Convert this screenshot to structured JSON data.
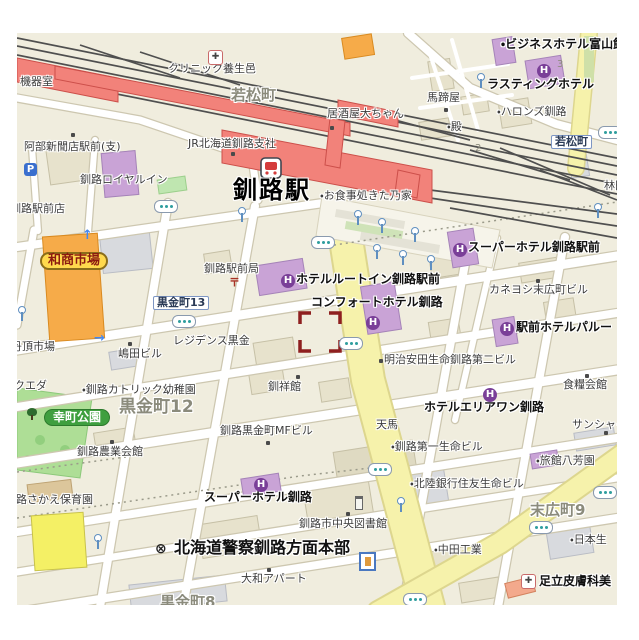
{
  "map": {
    "region_name": "釧路駅周辺 (Kushiro Station area)",
    "palette": {
      "station_red": "#f2827a",
      "hotel_purple": "#c9a3d6",
      "hotel_icon_purple": "#7a3f98",
      "market_orange": "#f6ab49",
      "park_green": "#aede96",
      "road_yellow": "#f6f2ab",
      "rail_gray": "#4f4f4f",
      "target_marker_red": "#8e1f1f",
      "block_beige": "#f0edde"
    },
    "labels": [
      {
        "text": "機器室",
        "x": 20,
        "y": 76,
        "cls": "poi",
        "name": "label-kikishitsu"
      },
      {
        "text": "クリニック養生邑",
        "x": 168,
        "y": 63,
        "cls": "poi",
        "name": "label-clinic-yojomura"
      },
      {
        "text": "若松町",
        "x": 231,
        "y": 88,
        "cls": "town",
        "name": "label-wakamatsucho"
      },
      {
        "text": "居酒屋大ちゃん",
        "x": 327,
        "y": 108,
        "cls": "poi",
        "name": "label-izakaya-daichan"
      },
      {
        "text": "馬蹄屋",
        "x": 427,
        "y": 92,
        "cls": "poi",
        "name": "label-bateiya"
      },
      {
        "text": "・殿",
        "x": 447,
        "y": 121,
        "cls": "poi",
        "name": "label-tono"
      },
      {
        "text": "・ビジネスホテル富山館",
        "x": 501,
        "y": 38,
        "cls": "hotel",
        "name": "label-business-hotel-toyamakan"
      },
      {
        "text": "ラスティングホテル",
        "x": 487,
        "y": 78,
        "cls": "hotel",
        "name": "label-lasting-hotel"
      },
      {
        "text": "・ハロンズ釧路",
        "x": 497,
        "y": 106,
        "cls": "poi",
        "name": "label-hallons-kushiro"
      },
      {
        "text": "若松町",
        "x": 551,
        "y": 135,
        "cls": "busbox",
        "name": "busstop-wakamatsucho"
      },
      {
        "text": "林田",
        "x": 604,
        "y": 180,
        "cls": "poi",
        "name": "label-hayashida"
      },
      {
        "text": "3",
        "x": 557,
        "y": 60,
        "cls": "num",
        "name": "label-block-3"
      },
      {
        "text": "2",
        "x": 475,
        "y": 144,
        "cls": "num",
        "name": "label-block-2"
      },
      {
        "text": "JR北海道釧路支社",
        "x": 188,
        "y": 138,
        "cls": "poi",
        "name": "label-jr-hokkaido-kushiro-branch"
      },
      {
        "text": "釧路駅",
        "x": 233,
        "y": 178,
        "cls": "station-name",
        "name": "label-kushiro-station"
      },
      {
        "text": "・お食事処きた乃家",
        "x": 320,
        "y": 190,
        "cls": "poi",
        "name": "label-oshokujidokoro-kitanoya"
      },
      {
        "text": "阿部新聞店駅前(支)",
        "x": 24,
        "y": 141,
        "cls": "poi",
        "name": "label-abe-shimbunten"
      },
      {
        "text": "釧路ロイヤルイン",
        "x": 80,
        "y": 174,
        "cls": "poi",
        "name": "label-kushiro-royal-inn"
      },
      {
        "text": "釧路駅前店",
        "x": 10,
        "y": 203,
        "cls": "poi",
        "name": "label-kushiro-ekimaeten"
      },
      {
        "text": "スーパーホテル釧路駅前",
        "x": 468,
        "y": 241,
        "cls": "hotel",
        "name": "label-super-hotel-kushiro-ekimae"
      },
      {
        "text": "和商市場",
        "x": 40,
        "y": 252,
        "cls": "pill-yellow",
        "name": "label-washo-ichiba"
      },
      {
        "text": "黒金町13",
        "x": 153,
        "y": 296,
        "cls": "busbox",
        "name": "busstop-kuroganecho-13"
      },
      {
        "text": "カネヨシ末広町ビル",
        "x": 489,
        "y": 284,
        "cls": "poi",
        "name": "label-kaneyoshi-suehirocho-bldg"
      },
      {
        "text": "ホテルルートイン釧路駅前",
        "x": 296,
        "y": 273,
        "cls": "hotel",
        "name": "label-hotel-route-inn-kushiro-ekimae"
      },
      {
        "text": "釧路駅前局",
        "x": 204,
        "y": 263,
        "cls": "poi",
        "name": "label-kushiro-ekimae-post-office"
      },
      {
        "text": "コンフォートホテル釧路",
        "x": 311,
        "y": 296,
        "cls": "hotel",
        "name": "label-comfort-hotel-kushiro"
      },
      {
        "text": "駅前ホテルパルー",
        "x": 516,
        "y": 321,
        "cls": "hotel",
        "name": "label-ekimae-hotel-paroo"
      },
      {
        "text": "明治安田生命釧路第二ビル",
        "x": 384,
        "y": 354,
        "cls": "poi",
        "name": "label-meiji-yasuda-seimei-2nd-bldg"
      },
      {
        "text": "レジデンス黒金",
        "x": 173,
        "y": 335,
        "cls": "poi",
        "name": "label-residence-kurogane"
      },
      {
        "text": "嶋田ビル",
        "x": 118,
        "y": 348,
        "cls": "poi",
        "name": "label-shimada-bldg"
      },
      {
        "text": "丹頂市場",
        "x": 11,
        "y": 341,
        "cls": "poi",
        "name": "label-tancho-ichiba"
      },
      {
        "text": "・釧路カトリック幼稚園",
        "x": 82,
        "y": 384,
        "cls": "poi",
        "name": "label-kushiro-catholic-kindergarten"
      },
      {
        "text": "黒金町12",
        "x": 119,
        "y": 399,
        "cls": "town-lg",
        "name": "label-kuroganecho-12"
      },
      {
        "text": "幸町公園",
        "x": 44,
        "y": 409,
        "cls": "pill-green",
        "name": "label-saiwaicho-park"
      },
      {
        "text": "クエダ",
        "x": 14,
        "y": 380,
        "cls": "poi",
        "name": "label-kueda"
      },
      {
        "text": "釧祥館",
        "x": 268,
        "y": 381,
        "cls": "poi",
        "name": "label-senshokan"
      },
      {
        "text": "食糧会館",
        "x": 563,
        "y": 379,
        "cls": "poi",
        "name": "label-shokuryo-kaikan"
      },
      {
        "text": "ホテルエリアワン釧路",
        "x": 424,
        "y": 401,
        "cls": "hotel",
        "name": "label-hotel-area-one-kushiro"
      },
      {
        "text": "天馬",
        "x": 376,
        "y": 419,
        "cls": "poi",
        "name": "label-tenma"
      },
      {
        "text": "釧路農業会館",
        "x": 77,
        "y": 446,
        "cls": "poi",
        "name": "label-kushiro-nogyo-kaikan"
      },
      {
        "text": "・釧路第一生命ビル",
        "x": 391,
        "y": 441,
        "cls": "poi",
        "name": "label-kushiro-daiichi-seimei-bldg"
      },
      {
        "text": "サンシャイ",
        "x": 572,
        "y": 419,
        "cls": "poi",
        "name": "label-sunshine"
      },
      {
        "text": "・旅館八芳園",
        "x": 536,
        "y": 455,
        "cls": "poi",
        "name": "label-ryokan-happoen"
      },
      {
        "text": "・北陸銀行住友生命ビル",
        "x": 410,
        "y": 478,
        "cls": "poi",
        "name": "label-hokuriku-bank-sumitomo-seimei-bldg"
      },
      {
        "text": "路さかえ保育園",
        "x": 16,
        "y": 494,
        "cls": "poi",
        "name": "label-sakae-hoikuen"
      },
      {
        "text": "釧路黒金町MFビル",
        "x": 220,
        "y": 425,
        "cls": "poi",
        "name": "label-kushiro-kuroganecho-mf-bldg"
      },
      {
        "text": "スーパーホテル釧路",
        "x": 204,
        "y": 491,
        "cls": "hotel",
        "name": "label-super-hotel-kushiro"
      },
      {
        "text": "釧路市中央図書館",
        "x": 299,
        "y": 518,
        "cls": "poi",
        "name": "label-kushiro-central-library"
      },
      {
        "text": "末広町9",
        "x": 530,
        "y": 503,
        "cls": "town",
        "name": "label-suehirocho-9"
      },
      {
        "text": "北海道警察釧路方面本部",
        "x": 174,
        "y": 540,
        "cls": "police",
        "name": "label-hokkaido-police-kushiro-hq"
      },
      {
        "text": "・中田工業",
        "x": 434,
        "y": 544,
        "cls": "poi",
        "name": "label-nakata-kogyo"
      },
      {
        "text": "・日本生",
        "x": 570,
        "y": 534,
        "cls": "poi",
        "name": "label-nihon-seimei"
      },
      {
        "text": "大和アパート",
        "x": 241,
        "y": 573,
        "cls": "poi",
        "name": "label-yamato-apart"
      },
      {
        "text": "黒金町8",
        "x": 160,
        "y": 595,
        "cls": "town",
        "name": "label-kuroganecho-8"
      },
      {
        "text": "足立皮膚科美",
        "x": 539,
        "y": 575,
        "cls": "poi-bold",
        "name": "label-adachi-hifuka"
      }
    ],
    "markers": [
      {
        "type": "hotel",
        "glyph": "H",
        "x": 453,
        "y": 243
      },
      {
        "type": "hotel",
        "glyph": "H",
        "x": 281,
        "y": 274
      },
      {
        "type": "hotel",
        "glyph": "H",
        "x": 366,
        "y": 316
      },
      {
        "type": "hotel",
        "glyph": "H",
        "x": 500,
        "y": 322
      },
      {
        "type": "hotel",
        "glyph": "H",
        "x": 483,
        "y": 388
      },
      {
        "type": "hotel",
        "glyph": "H",
        "x": 254,
        "y": 478
      },
      {
        "type": "hotel",
        "glyph": "H",
        "x": 537,
        "y": 64
      },
      {
        "type": "hospital",
        "glyph": "✚",
        "x": 208,
        "y": 50
      },
      {
        "type": "hospital",
        "glyph": "✚",
        "x": 521,
        "y": 574
      },
      {
        "type": "parking",
        "glyph": "P",
        "x": 24,
        "y": 163
      },
      {
        "type": "police-badge",
        "glyph": "⊗",
        "x": 155,
        "y": 542
      },
      {
        "type": "postoffice",
        "glyph": "〒",
        "x": 229,
        "y": 277
      },
      {
        "type": "busstop",
        "x": 154,
        "y": 200
      },
      {
        "type": "busstop",
        "x": 172,
        "y": 315
      },
      {
        "type": "busstop",
        "x": 311,
        "y": 236
      },
      {
        "type": "busstop",
        "x": 339,
        "y": 337
      },
      {
        "type": "busstop",
        "x": 598,
        "y": 126
      },
      {
        "type": "busstop",
        "x": 368,
        "y": 463
      },
      {
        "type": "busstop",
        "x": 593,
        "y": 486
      },
      {
        "type": "busstop",
        "x": 529,
        "y": 521
      },
      {
        "type": "busstop",
        "x": 403,
        "y": 593
      },
      {
        "type": "pole",
        "x": 237,
        "y": 207
      },
      {
        "type": "pole",
        "x": 353,
        "y": 210
      },
      {
        "type": "pole",
        "x": 377,
        "y": 218
      },
      {
        "type": "pole",
        "x": 410,
        "y": 227
      },
      {
        "type": "pole",
        "x": 372,
        "y": 244
      },
      {
        "type": "pole",
        "x": 398,
        "y": 250
      },
      {
        "type": "pole",
        "x": 426,
        "y": 255
      },
      {
        "type": "pole",
        "x": 593,
        "y": 203
      },
      {
        "type": "pole",
        "x": 476,
        "y": 73
      },
      {
        "type": "pole",
        "x": 93,
        "y": 534
      },
      {
        "type": "pole",
        "x": 396,
        "y": 497
      },
      {
        "type": "pole",
        "x": 17,
        "y": 306
      },
      {
        "type": "poi-dot",
        "x": 330,
        "y": 126
      },
      {
        "type": "poi-dot",
        "x": 444,
        "y": 108
      },
      {
        "type": "poi-dot",
        "x": 231,
        "y": 152
      },
      {
        "type": "poi-dot",
        "x": 71,
        "y": 133
      },
      {
        "type": "poi-dot",
        "x": 536,
        "y": 279
      },
      {
        "type": "poi-dot",
        "x": 379,
        "y": 359
      },
      {
        "type": "poi-dot",
        "x": 128,
        "y": 342
      },
      {
        "type": "poi-dot",
        "x": 296,
        "y": 375
      },
      {
        "type": "poi-dot",
        "x": 585,
        "y": 374
      },
      {
        "type": "poi-dot",
        "x": 110,
        "y": 440
      },
      {
        "type": "poi-dot",
        "x": 266,
        "y": 441
      },
      {
        "type": "poi-dot",
        "x": 346,
        "y": 512
      },
      {
        "type": "poi-dot",
        "x": 267,
        "y": 568
      },
      {
        "type": "poi-dot",
        "x": 604,
        "y": 431
      },
      {
        "type": "tree",
        "x": 27,
        "y": 408
      },
      {
        "type": "monument",
        "x": 355,
        "y": 496
      },
      {
        "type": "shrine",
        "x": 359,
        "y": 552
      },
      {
        "type": "arrow-up",
        "glyph": "↑",
        "x": 82,
        "y": 228
      },
      {
        "type": "arrow-right",
        "glyph": "→",
        "x": 94,
        "y": 331
      }
    ],
    "target_marker": {
      "x": 300,
      "y": 313,
      "width": 40,
      "height": 38
    }
  }
}
